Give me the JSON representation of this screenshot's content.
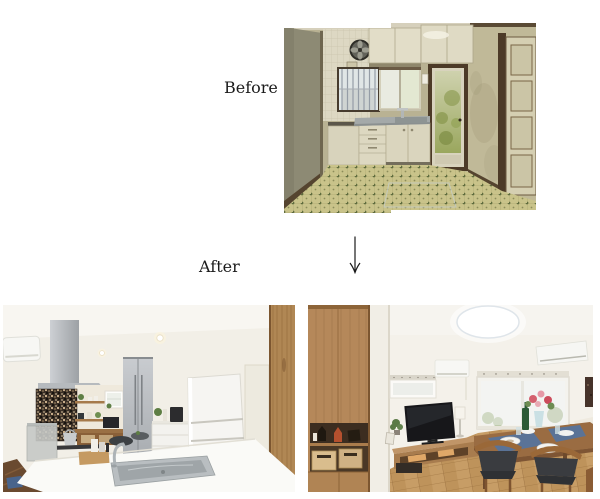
{
  "page": {
    "background": "#ffffff",
    "width": 600,
    "height": 499
  },
  "before_section": {
    "label": "Before",
    "photo_alt": "Dated kitchen before renovation: beige stained walls, cream upper and lower cabinets, wall ventilation fan, barred window, glass back door with greenery, stainless counter and yellow-green checkered tile floor"
  },
  "transition": {
    "arrow_glyph": "↓"
  },
  "after_section": {
    "label": "After",
    "kitchen_photo_alt": "Renovated kitchen: stainless range hood, dark mosaic tile accent wall, open wood shelves, silver tall cabinets, white refrigerator, white island counter with stainless sink, wood pillar",
    "living_photo_alt": "Renovated living-dining room: tall wood shelving unit with display niche, round LED ceiling light, two air conditioners, windows, TV on low wood board, wood dining table with blue placemats, white plates, flowers and dark upholstered chairs, oak flooring"
  },
  "palette": {
    "label_text": "#1b1b1b",
    "old_wall": "#b9b293",
    "old_cabinet": "#e0dbc6",
    "old_floor_tile": "#c9c38a",
    "dark_wood_trim": "#4c3a27",
    "new_wall": "#f2efe7",
    "steel": "#b6babe",
    "wood": "#b0875a",
    "floor_wood": "#c79d66",
    "accent_blue_mat": "#56749c"
  }
}
